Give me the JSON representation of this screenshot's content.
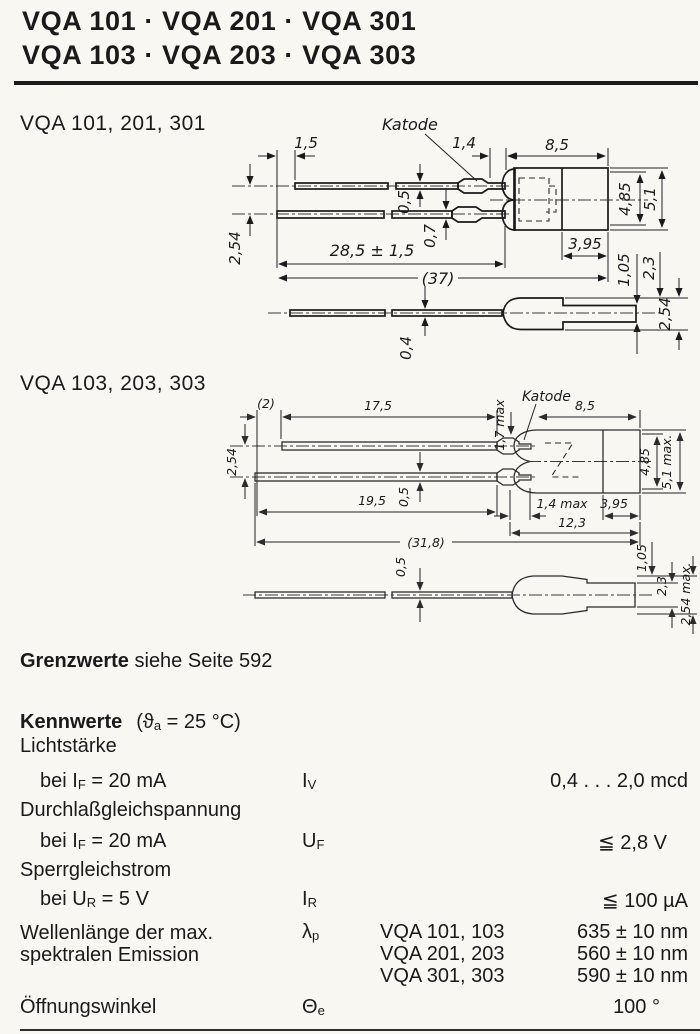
{
  "page": {
    "paper_color": "#f8f7f2",
    "ink_color": "#1a1a1a",
    "title_line1": "VQA 101 · VQA 201 · VQA 301",
    "title_line2": "VQA 103 · VQA 203 · VQA 303"
  },
  "drawing1": {
    "label": "VQA 101, 201, 301",
    "katode_label": "Katode",
    "dims": {
      "lead_offset": "1,5",
      "crimp_len": "1,4",
      "body_len": "8,5",
      "lead_thick_top": "0,5",
      "lead_thick_bottom": "0,7",
      "lead_pitch": "2,54",
      "lead_len": "28,5 ± 1,5",
      "total_len": "(37)",
      "body_dia_inner": "4,85",
      "body_dia_outer": "5,1",
      "dome_len": "3,95",
      "side_step": "1,05",
      "side_body": "2,3",
      "side_height": "2,54",
      "side_lead_thick": "0,4"
    }
  },
  "drawing2": {
    "label": "VQA 103, 203, 303",
    "katode_label": "Katode",
    "dims": {
      "lead_offset": "(2)",
      "lead_top_len": "17,5",
      "crimp_thick": "1,7 max",
      "body_len": "8,5",
      "lead_pitch": "2,54",
      "lead_thick": "0,5",
      "lead_bottom_len": "19,5",
      "crimp_len": "1,4 max",
      "dome_len": "3,95",
      "body_total_len": "12,3",
      "total_len": "(31,8)",
      "body_dia_inner": "4,85",
      "body_dia_outer": "5,1 max.",
      "side_lead_thick": "0,5",
      "side_step": "1,05",
      "side_body": "2,3",
      "side_height": "2,54 max."
    }
  },
  "grenzwerte": {
    "label_bold": "Grenzwerte",
    "label_rest": " siehe Seite 592"
  },
  "kennwerte": {
    "heading_bold": "Kennwerte",
    "heading_pre": "(ϑ",
    "heading_sub": "a",
    "heading_post": " = 25 °C)",
    "rows": [
      {
        "name": "Lichtstärke",
        "cond_pre": "bei I",
        "cond_sub": "F",
        "cond_post": " = 20 mA",
        "sym_pre": "I",
        "sym_sub": "V",
        "value": "0,4 . . . 2,0 mcd"
      },
      {
        "name": "Durchlaßgleichspannung",
        "cond_pre": "bei I",
        "cond_sub": "F",
        "cond_post": " = 20 mA",
        "sym_pre": "U",
        "sym_sub": "F",
        "value": "≦ 2,8 V"
      },
      {
        "name": "Sperrgleichstrom",
        "cond_pre": "bei U",
        "cond_sub": "R",
        "cond_post": " = 5 V",
        "sym_pre": "I",
        "sym_sub": "R",
        "value": "≦ 100 µA"
      }
    ],
    "wavelength": {
      "name_line1": "Wellenlänge der max.",
      "name_line2": "spektralen Emission",
      "sym_pre": "λ",
      "sym_sub": "p",
      "variants": [
        {
          "types": "VQA 101, 103",
          "value": "635 ± 10 nm"
        },
        {
          "types": "VQA 201, 203",
          "value": "560 ± 10 nm"
        },
        {
          "types": "VQA 301, 303",
          "value": "590 ± 10 nm"
        }
      ]
    },
    "angle": {
      "name": "Öffnungswinkel",
      "sym_pre": "Θ",
      "sym_sub": "e",
      "value": "100 °"
    }
  }
}
